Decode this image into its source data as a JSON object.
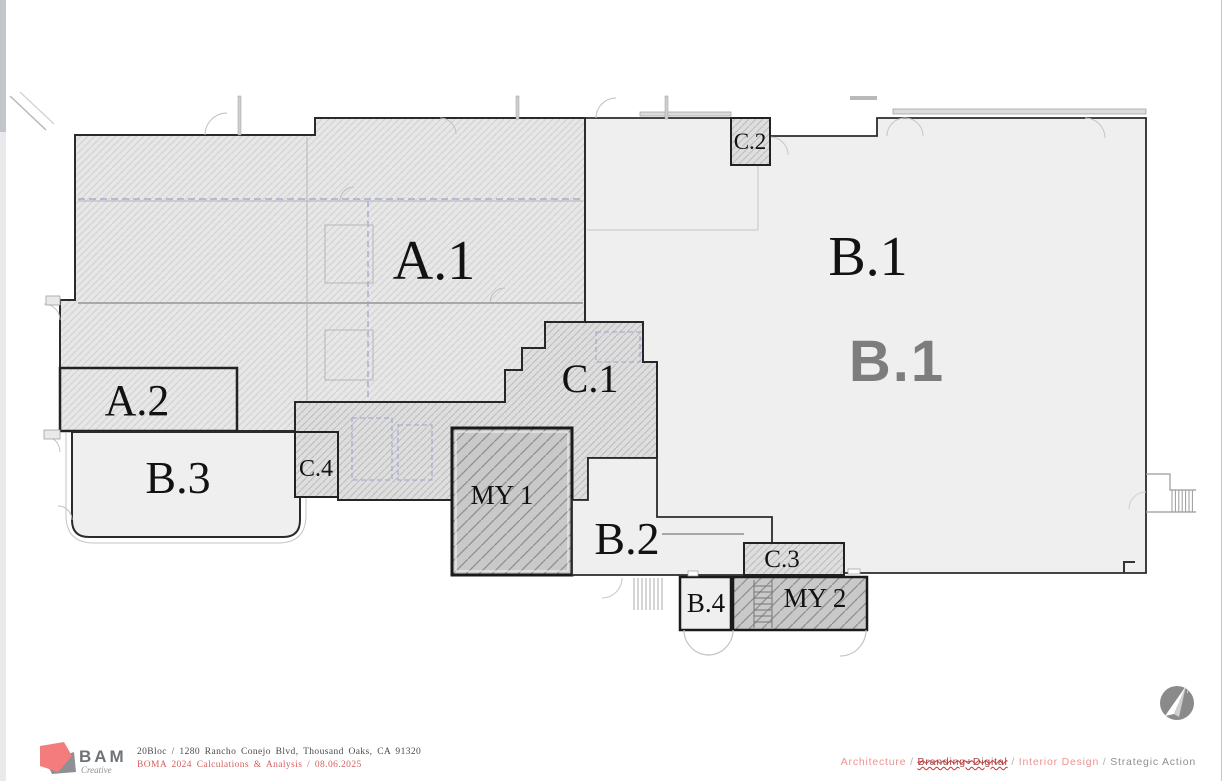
{
  "plan": {
    "zones": [
      {
        "id": "a1",
        "label": "A.1"
      },
      {
        "id": "a2",
        "label": "A.2"
      },
      {
        "id": "b1",
        "label": "B.1",
        "watermark": "B.1"
      },
      {
        "id": "b2",
        "label": "B.2"
      },
      {
        "id": "b3",
        "label": "B.3"
      },
      {
        "id": "b4",
        "label": "B.4"
      },
      {
        "id": "c1",
        "label": "C.1"
      },
      {
        "id": "c2",
        "label": "C.2"
      },
      {
        "id": "c3",
        "label": "C.3"
      },
      {
        "id": "c4",
        "label": "C.4"
      },
      {
        "id": "my1",
        "label": "MY 1"
      },
      {
        "id": "my2",
        "label": "MY 2"
      }
    ],
    "north_label": "N",
    "colors": {
      "zone_a_fill": "#e7e7e7",
      "zone_b_fill": "#efefef",
      "zone_c_fill": "#dedede",
      "zone_my_fill": "#c9c9c9",
      "outline": "#2b2b2b",
      "watermark": "#7d7d7d",
      "compass": "#8a8a8a"
    }
  },
  "footer": {
    "brand": {
      "name": "BAM",
      "tagline": "Creative",
      "logo_pink": "#f47c7c",
      "logo_gray": "#8d9094"
    },
    "address_line": "20Bloc / 1280 Rancho Conejo Blvd, Thousand Oaks, CA 91320",
    "boma_line": "BOMA 2024 Calculations & Analysis / 08.06.2025",
    "services": {
      "sep": "/",
      "items": [
        {
          "label": "Architecture"
        },
        {
          "label": "Branding+Digital"
        },
        {
          "label": "Interior Design"
        },
        {
          "label": "Strategic Action"
        }
      ]
    }
  }
}
